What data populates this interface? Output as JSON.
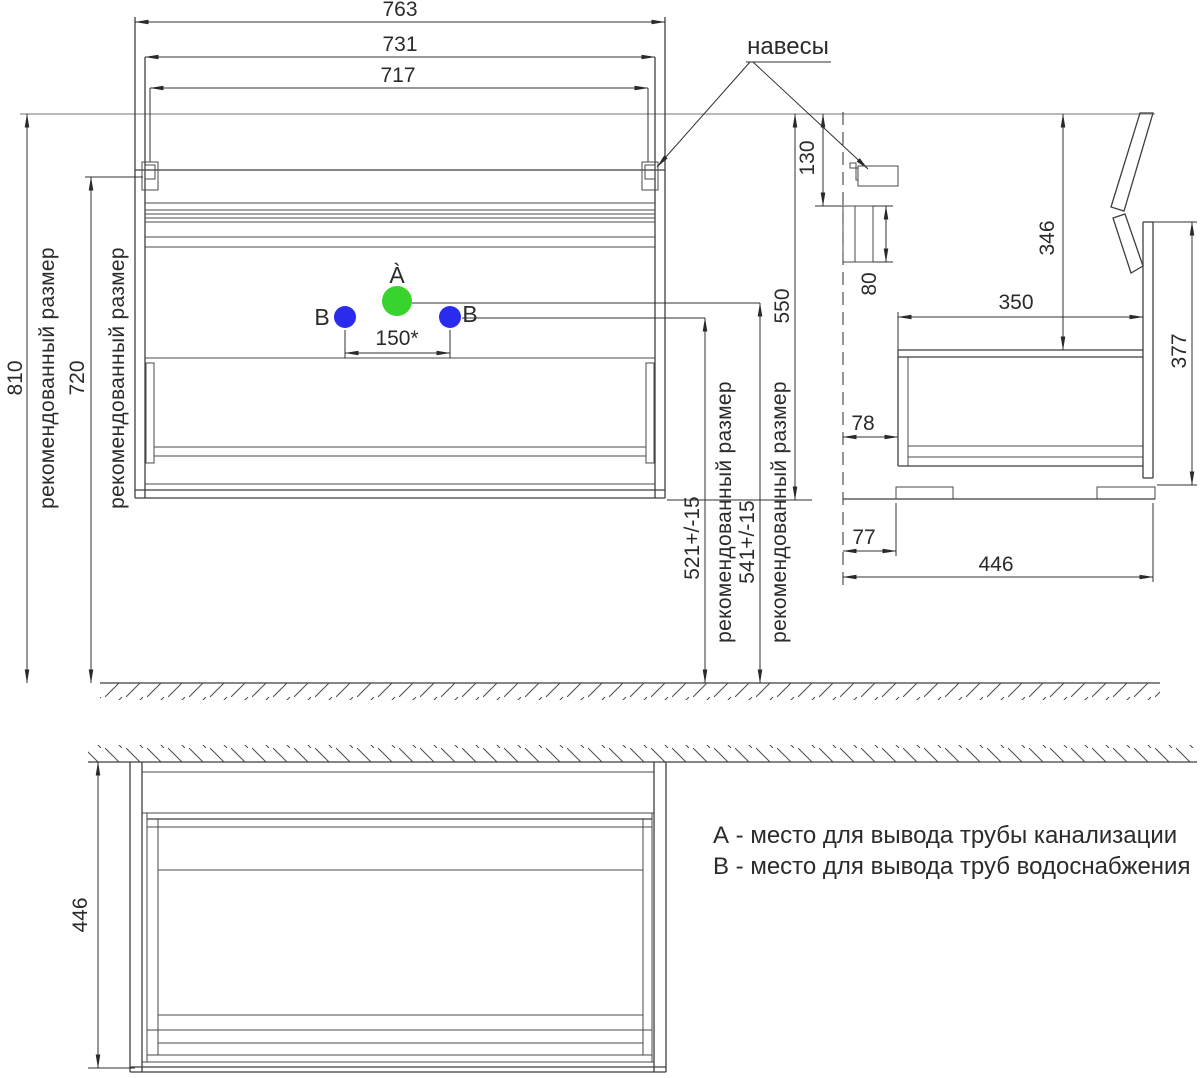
{
  "colors": {
    "ink": "#3f3f3f",
    "dim_line": "#303030",
    "grey_guide": "#a3a3a3",
    "point_a_fill": "#38d32d",
    "point_b_fill": "#2b2bee"
  },
  "labels": {
    "hangers_callout": "навесы",
    "point_a": "À",
    "point_b_left": "B",
    "point_b_right": "B"
  },
  "dims": {
    "w763": "763",
    "w731": "731",
    "w717": "717",
    "h810": "810",
    "h720": "720",
    "rec": "рекомендованный размер",
    "d150": "150*",
    "h521": "521+/-15",
    "h541": "541+/-15",
    "h550": "550",
    "d130": "130",
    "d80": "80",
    "d346": "346",
    "d350": "350",
    "d377": "377",
    "d78": "78",
    "d77": "77",
    "d446_side": "446",
    "d446_plan": "446"
  },
  "annotations": {
    "a": "А - место для вывода трубы канализации",
    "b": "В - место для вывода труб водоснабжения"
  }
}
